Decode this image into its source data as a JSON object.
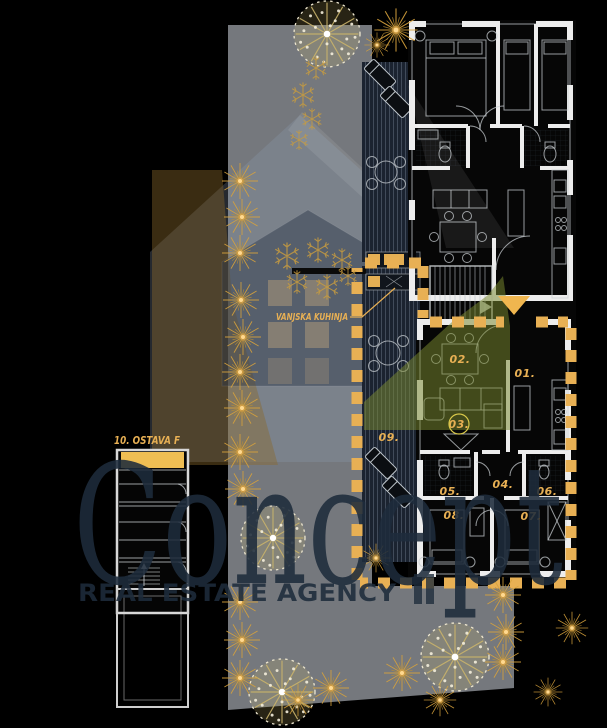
{
  "watermark": {
    "brand": "Concept",
    "tagline": "REAL ESTATE AGENCY"
  },
  "annotations": {
    "outdoor_kitchen": "VANJSKA KUHINJA",
    "storage_label": "10. OSTAVA F"
  },
  "plan": {
    "rooms": [
      {
        "id": "01."
      },
      {
        "id": "02."
      },
      {
        "id": "03."
      },
      {
        "id": "04."
      },
      {
        "id": "05."
      },
      {
        "id": "06."
      },
      {
        "id": "07."
      },
      {
        "id": "08."
      },
      {
        "id": "09."
      }
    ]
  },
  "colors": {
    "gold": "#E8B054",
    "highlight_green": "#7A8A30",
    "yard_gray": "#75787D",
    "watermark_navy": "#1E2C3C",
    "plan_wall": "#EDEDED"
  }
}
